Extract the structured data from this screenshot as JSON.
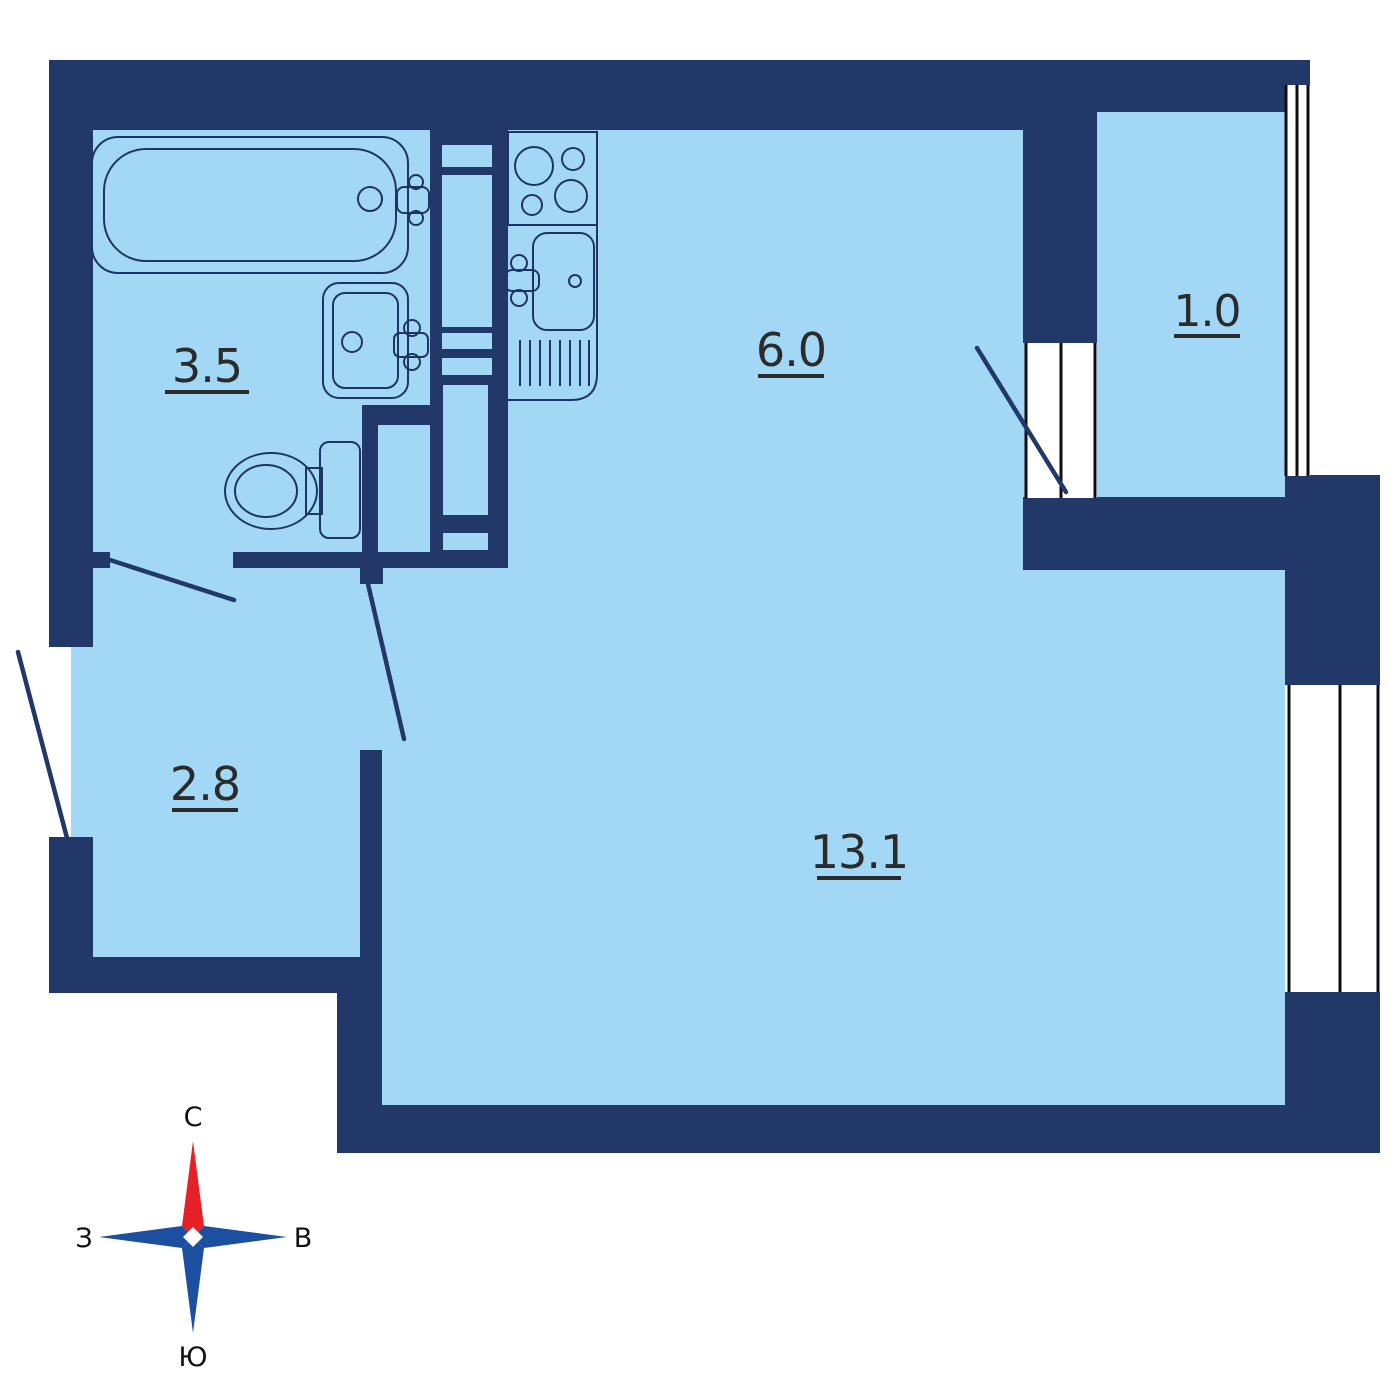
{
  "rooms": {
    "bathroom": {
      "area": "3.5"
    },
    "kitchen": {
      "area": "6.0"
    },
    "balcony": {
      "area": "1.0"
    },
    "hallway": {
      "area": "2.8"
    },
    "living": {
      "area": "13.1"
    }
  },
  "compass": {
    "north_label": "С",
    "south_label": "Ю",
    "west_label": "З",
    "east_label": "В"
  },
  "colors": {
    "wall": "#223869",
    "floor": "#a2d8f6",
    "fixture_outline": "#1e3563",
    "window_fill": "#ffffff",
    "window_line": "#0d0d16",
    "compass_north": "#e52127",
    "compass_other": "#1c4fa0",
    "label_text": "#2b2b2b"
  }
}
